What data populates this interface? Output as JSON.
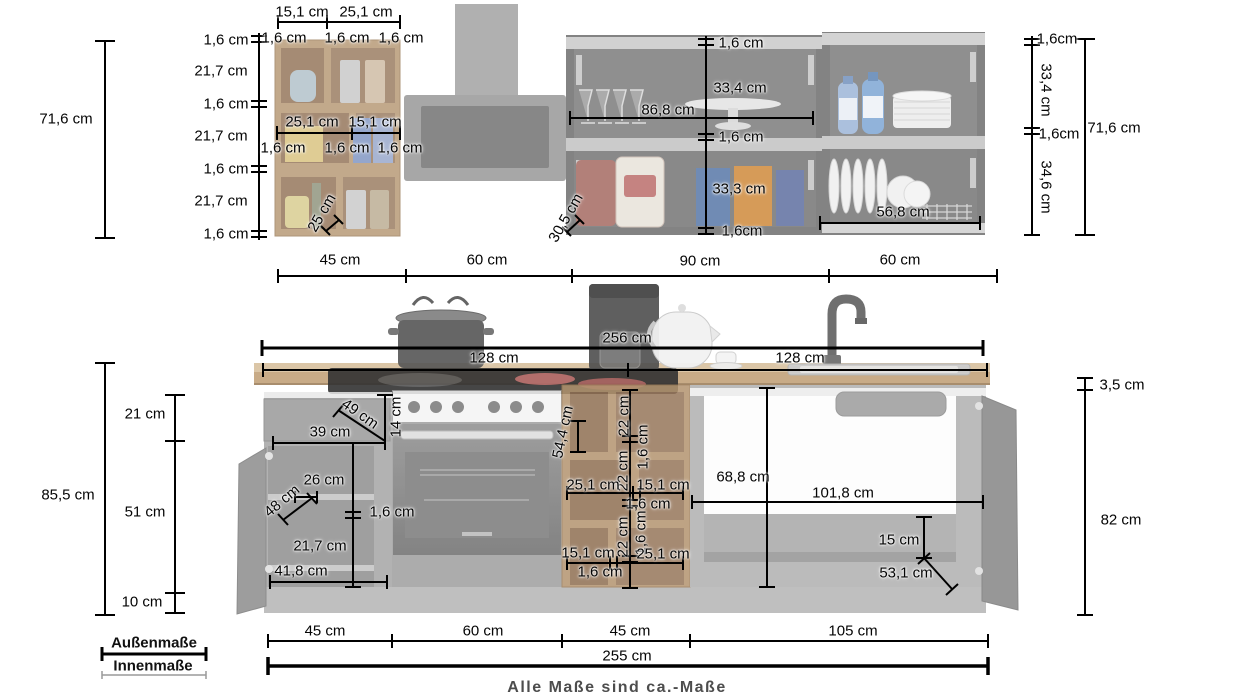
{
  "footer": {
    "note": "Alle Maße sind ca.-Maße"
  },
  "legend": {
    "outer_label": "Außenmaße",
    "inner_label": "Innenmaße"
  },
  "colors": {
    "dimension_line": "#000000",
    "inner_dimension_line": "#9a9a9a",
    "footer_text": "#4d4d4d",
    "wood": "#b89a7c",
    "carcass_gray": "#aeaeae",
    "dark_front": "#8c8c8c"
  },
  "dimension_labels": [
    {
      "group": "wall-shelf-left",
      "text": "15,1 cm",
      "x": 302,
      "y": 12
    },
    {
      "group": "wall-shelf-left",
      "text": "25,1 cm",
      "x": 366,
      "y": 12
    },
    {
      "group": "wall-shelf-left",
      "text": "1,6 cm",
      "x": 284,
      "y": 38
    },
    {
      "group": "wall-shelf-left",
      "text": "1,6 cm",
      "x": 347,
      "y": 38
    },
    {
      "group": "wall-shelf-left",
      "text": "1,6 cm",
      "x": 401,
      "y": 38
    },
    {
      "group": "wall-shelf-left",
      "text": "1,6 cm",
      "x": 226,
      "y": 40
    },
    {
      "group": "wall-shelf-left",
      "text": "21,7 cm",
      "x": 221,
      "y": 71
    },
    {
      "group": "wall-shelf-left",
      "text": "1,6 cm",
      "x": 226,
      "y": 104
    },
    {
      "group": "wall-shelf-left",
      "text": "21,7 cm",
      "x": 221,
      "y": 136
    },
    {
      "group": "wall-shelf-left",
      "text": "1,6 cm",
      "x": 226,
      "y": 169
    },
    {
      "group": "wall-shelf-left",
      "text": "21,7 cm",
      "x": 221,
      "y": 201
    },
    {
      "group": "wall-shelf-left",
      "text": "1,6 cm",
      "x": 226,
      "y": 234
    },
    {
      "group": "wall-shelf-left",
      "text": "25,1 cm",
      "x": 312,
      "y": 122
    },
    {
      "group": "wall-shelf-left",
      "text": "15,1 cm",
      "x": 375,
      "y": 122
    },
    {
      "group": "wall-shelf-left",
      "text": "1,6 cm",
      "x": 283,
      "y": 148
    },
    {
      "group": "wall-shelf-left",
      "text": "1,6 cm",
      "x": 347,
      "y": 148
    },
    {
      "group": "wall-shelf-left",
      "text": "1,6 cm",
      "x": 400,
      "y": 148
    },
    {
      "group": "wall-shelf-left",
      "text": "25 cm",
      "x": 322,
      "y": 213,
      "rot": -60
    },
    {
      "group": "wall-shelf-left",
      "text": "71,6 cm",
      "x": 66,
      "y": 119
    },
    {
      "group": "wall-unit-mid",
      "text": "1,6 cm",
      "x": 741,
      "y": 43
    },
    {
      "group": "wall-unit-mid",
      "text": "33,4 cm",
      "x": 740,
      "y": 88
    },
    {
      "group": "wall-unit-mid",
      "text": "86,8 cm",
      "x": 668,
      "y": 110
    },
    {
      "group": "wall-unit-mid",
      "text": "1,6 cm",
      "x": 741,
      "y": 137
    },
    {
      "group": "wall-unit-mid",
      "text": "33,3 cm",
      "x": 739,
      "y": 189
    },
    {
      "group": "wall-unit-mid",
      "text": "1,6cm",
      "x": 742,
      "y": 231
    },
    {
      "group": "wall-unit-mid",
      "text": "30,5 cm",
      "x": 566,
      "y": 218,
      "rot": -60
    },
    {
      "group": "wall-unit-right",
      "text": "56,8 cm",
      "x": 903,
      "y": 212
    },
    {
      "group": "wall-unit-right",
      "text": "1,6cm",
      "x": 1057,
      "y": 39
    },
    {
      "group": "wall-unit-right",
      "text": "33,4 cm",
      "x": 1046,
      "y": 90,
      "rot": 90
    },
    {
      "group": "wall-unit-right",
      "text": "1,6cm",
      "x": 1059,
      "y": 134
    },
    {
      "group": "wall-unit-right",
      "text": "34,6 cm",
      "x": 1046,
      "y": 187,
      "rot": 90
    },
    {
      "group": "wall-unit-right",
      "text": "71,6 cm",
      "x": 1114,
      "y": 128
    },
    {
      "group": "width-row-top",
      "text": "45 cm",
      "x": 340,
      "y": 260
    },
    {
      "group": "width-row-top",
      "text": "60 cm",
      "x": 487,
      "y": 260
    },
    {
      "group": "width-row-top",
      "text": "90 cm",
      "x": 700,
      "y": 261
    },
    {
      "group": "width-row-top",
      "text": "60 cm",
      "x": 900,
      "y": 260
    },
    {
      "group": "countertop",
      "text": "256 cm",
      "x": 627,
      "y": 338
    },
    {
      "group": "countertop",
      "text": "128 cm",
      "x": 494,
      "y": 358
    },
    {
      "group": "countertop",
      "text": "128 cm",
      "x": 800,
      "y": 358
    },
    {
      "group": "base-left-heights",
      "text": "85,5 cm",
      "x": 68,
      "y": 495
    },
    {
      "group": "base-left-heights",
      "text": "21 cm",
      "x": 145,
      "y": 414
    },
    {
      "group": "base-left-heights",
      "text": "51 cm",
      "x": 145,
      "y": 512
    },
    {
      "group": "base-left-heights",
      "text": "10 cm",
      "x": 142,
      "y": 602
    },
    {
      "group": "base-cabinet-left",
      "text": "49 cm",
      "x": 360,
      "y": 414,
      "rot": 35
    },
    {
      "group": "base-cabinet-left",
      "text": "14 cm",
      "x": 396,
      "y": 417,
      "rot": -90
    },
    {
      "group": "base-cabinet-left",
      "text": "39 cm",
      "x": 330,
      "y": 432
    },
    {
      "group": "base-cabinet-left",
      "text": "26 cm",
      "x": 324,
      "y": 480
    },
    {
      "group": "base-cabinet-left",
      "text": "48 cm",
      "x": 282,
      "y": 501,
      "rot": -40
    },
    {
      "group": "base-cabinet-left",
      "text": "1,6 cm",
      "x": 392,
      "y": 512
    },
    {
      "group": "base-cabinet-left",
      "text": "21,7 cm",
      "x": 320,
      "y": 546
    },
    {
      "group": "base-cabinet-left",
      "text": "41,8 cm",
      "x": 301,
      "y": 571
    },
    {
      "group": "base-shelf-mid",
      "text": "54,4 cm",
      "x": 563,
      "y": 432,
      "rot": -78
    },
    {
      "group": "base-shelf-mid",
      "text": "22 cm",
      "x": 624,
      "y": 416,
      "rot": -90
    },
    {
      "group": "base-shelf-mid",
      "text": "1,6 cm",
      "x": 643,
      "y": 447,
      "rot": -90
    },
    {
      "group": "base-shelf-mid",
      "text": "22 cm",
      "x": 623,
      "y": 471,
      "rot": -90
    },
    {
      "group": "base-shelf-mid",
      "text": "25,1 cm",
      "x": 593,
      "y": 485
    },
    {
      "group": "base-shelf-mid",
      "text": "15,1 cm",
      "x": 663,
      "y": 485
    },
    {
      "group": "base-shelf-mid",
      "text": "1,6 cm",
      "x": 648,
      "y": 504
    },
    {
      "group": "base-shelf-mid",
      "text": "1,6 cm",
      "x": 641,
      "y": 533,
      "rot": -90
    },
    {
      "group": "base-shelf-mid",
      "text": "22 cm",
      "x": 623,
      "y": 537,
      "rot": -90
    },
    {
      "group": "base-shelf-mid",
      "text": "15,1 cm",
      "x": 588,
      "y": 553
    },
    {
      "group": "base-shelf-mid",
      "text": "25,1 cm",
      "x": 663,
      "y": 554
    },
    {
      "group": "base-shelf-mid",
      "text": "1,6 cm",
      "x": 600,
      "y": 572
    },
    {
      "group": "base-sink",
      "text": "68,8 cm",
      "x": 743,
      "y": 477
    },
    {
      "group": "base-sink",
      "text": "101,8 cm",
      "x": 843,
      "y": 493
    },
    {
      "group": "base-sink",
      "text": "15 cm",
      "x": 899,
      "y": 540
    },
    {
      "group": "base-sink",
      "text": "53,1 cm",
      "x": 906,
      "y": 573
    },
    {
      "group": "right-heights",
      "text": "3,5 cm",
      "x": 1122,
      "y": 385
    },
    {
      "group": "right-heights",
      "text": "82 cm",
      "x": 1121,
      "y": 520
    },
    {
      "group": "width-row-bottom",
      "text": "45 cm",
      "x": 325,
      "y": 631
    },
    {
      "group": "width-row-bottom",
      "text": "60 cm",
      "x": 483,
      "y": 631
    },
    {
      "group": "width-row-bottom",
      "text": "45 cm",
      "x": 630,
      "y": 631
    },
    {
      "group": "width-row-bottom",
      "text": "105 cm",
      "x": 853,
      "y": 631
    },
    {
      "group": "total-width",
      "text": "255 cm",
      "x": 627,
      "y": 656
    }
  ]
}
